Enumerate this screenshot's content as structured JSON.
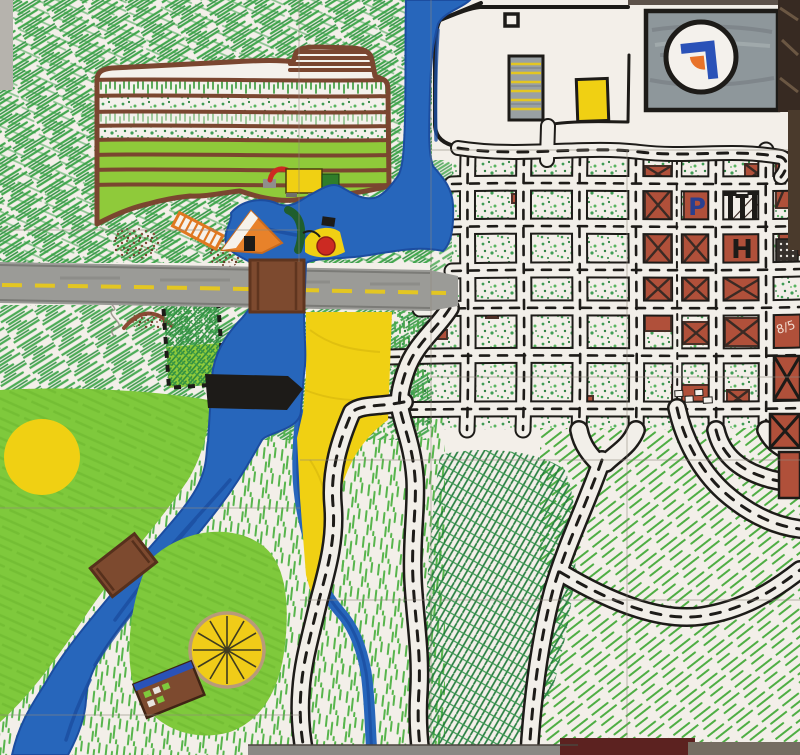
{
  "colors": {
    "paper": "#f3efe9",
    "ink": "#1d1b18",
    "river": "#2766bb",
    "river_dark": "#1c4da0",
    "road_gray": "#9b9b97",
    "road_stripe": "#e3c622",
    "bridge_brown": "#7d4a2f",
    "farm_outline": "#7a4630",
    "farm_band_green": "#8fca3a",
    "field_yellow": "#f0d013",
    "park_green": "#7fc93c",
    "brick_red": "#b0503a",
    "block_mark": "#3a2a24",
    "hatch_green": "#43a84e",
    "hatch_dark": "#1f7a3a",
    "speckle_green": "#3f9e55",
    "panel_gray": "#8e979b",
    "logo_blue": "#2a52b8",
    "logo_orange": "#e8732a",
    "tent_orange": "#e8822a",
    "dam_black": "#1d1b18",
    "wheel_yellow": "#f0cc18",
    "photo_brown": "#372a22",
    "table_gray": "#8a8884",
    "table_red": "#5c2220"
  },
  "labels": {
    "parking": "P",
    "hospital": "H",
    "police": "Polizei",
    "block_code": "8/5"
  },
  "icons": [
    "compass-logo-icon",
    "tractor-icon",
    "tent-icon",
    "ladder-sign-icon",
    "ferris-wheel-icon",
    "factory-towers-icon",
    "dam-icon",
    "bridge-icon"
  ]
}
